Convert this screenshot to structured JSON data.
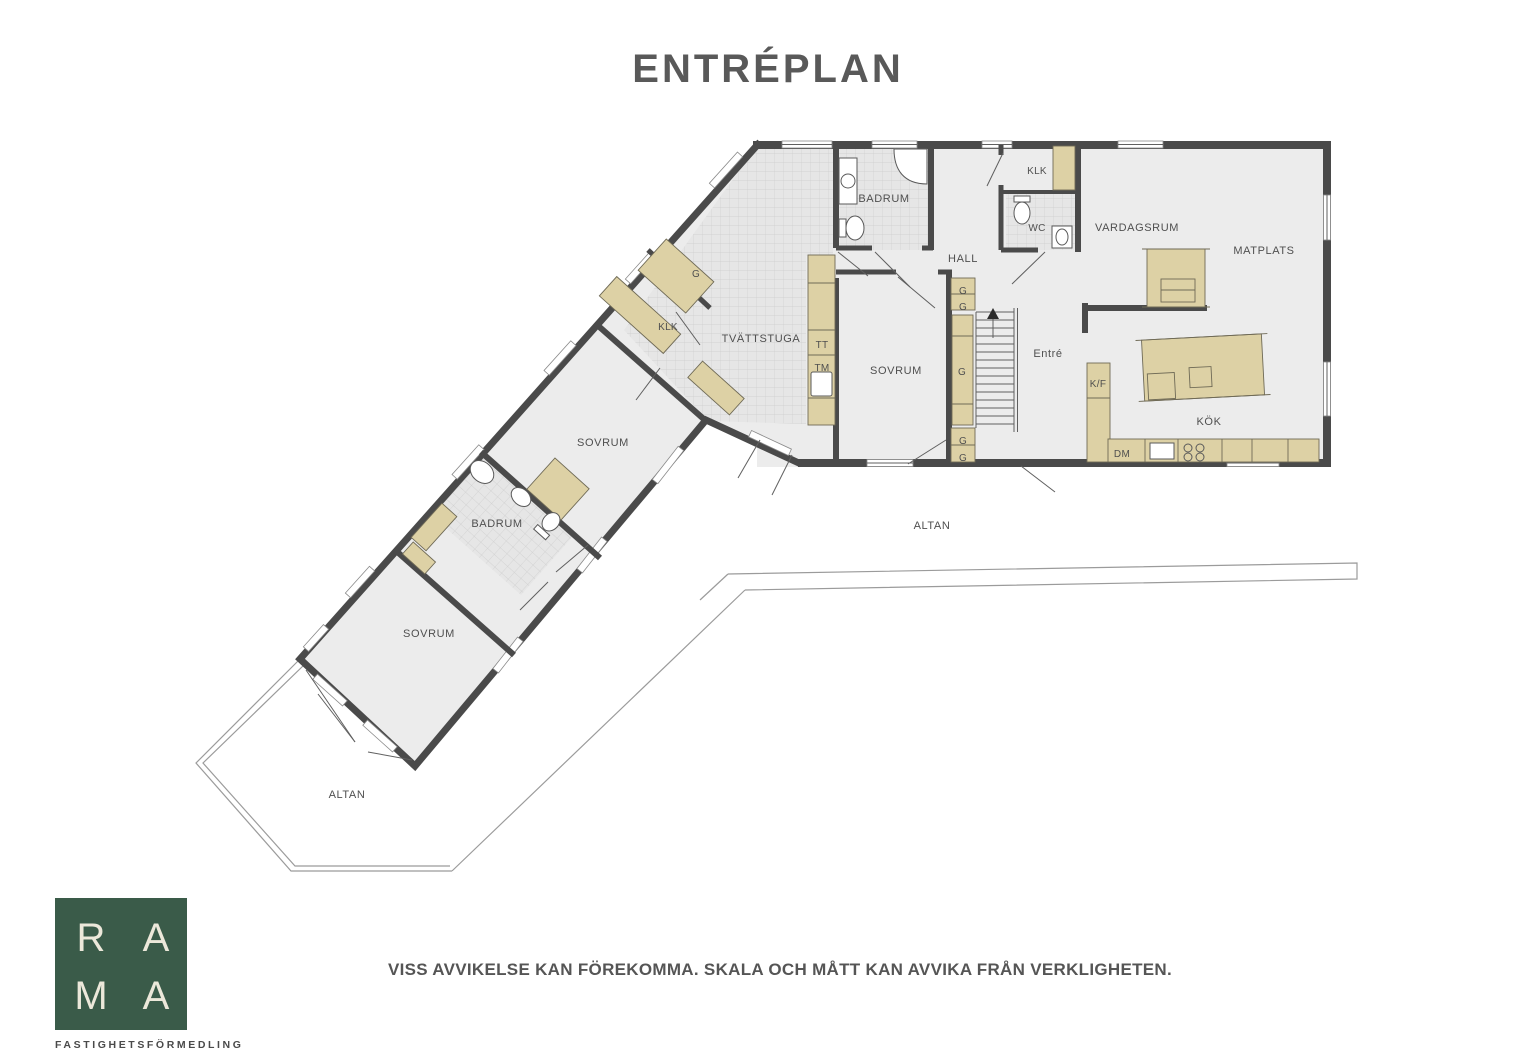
{
  "title": "ENTRÉPLAN",
  "disclaimer": "VISS AVVIKELSE KAN FÖREKOMMA. SKALA OCH MÅTT KAN AVVIKA FRÅN VERKLIGHETEN.",
  "logo": {
    "r": "R",
    "a1": "A",
    "m": "M",
    "a2": "A",
    "subtitle": "FASTIGHETSFÖRMEDLING"
  },
  "colors": {
    "wall": "#4a4a4a",
    "floor": "#ececec",
    "tile_floor": "#e6e6e6",
    "furniture": "#ddd1a5",
    "logo_green": "#3a5b49",
    "logo_cream": "#ece8da",
    "text": "#4f4f4f"
  },
  "rooms": {
    "badrum_top": "BADRUM",
    "klk_top": "KLK",
    "wc": "WC",
    "hall": "HALL",
    "vardagsrum": "VARDAGSRUM",
    "matplats": "MATPLATS",
    "tvattstuga": "TVÄTTSTUGA",
    "sovrum_main": "SOVRUM",
    "entre": "Entré",
    "kok": "KÖK",
    "klk_wing": "KLK",
    "sovrum_mid": "SOVRUM",
    "badrum_wing": "BADRUM",
    "sovrum_low": "SOVRUM",
    "altan_right": "ALTAN",
    "altan_left": "ALTAN"
  },
  "fixtures": {
    "tt": "TT",
    "tm": "TM",
    "kf": "K/F",
    "dm": "DM",
    "g": "G"
  }
}
